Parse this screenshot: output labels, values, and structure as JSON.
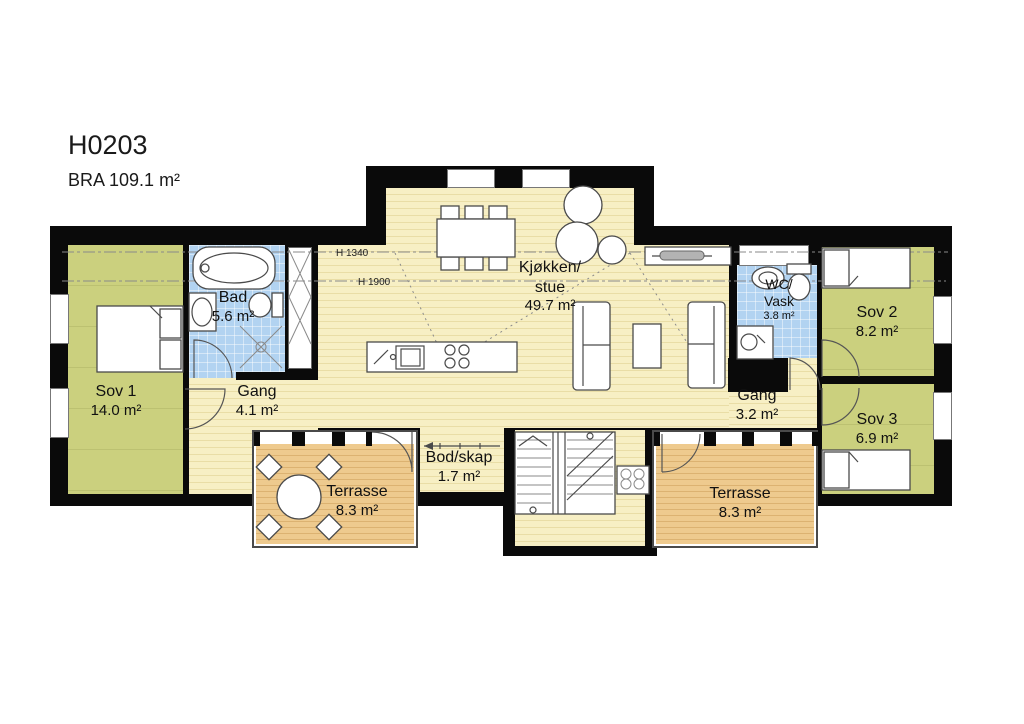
{
  "header": {
    "title": "H0203",
    "area_label": "BRA 109.1 m²"
  },
  "colors": {
    "wall_black": "#0a0a0a",
    "bedroom_green": "#cbd07e",
    "bathroom_blue": "#b2d3f1",
    "floor_yellow": "#f7efc4",
    "terrace_tan": "#eeca8e"
  },
  "rooms": {
    "sov1": {
      "name": "Sov 1",
      "area": "14.0 m²"
    },
    "bad": {
      "name": "Bad",
      "area": "5.6 m²"
    },
    "gang1": {
      "name": "Gang",
      "area": "4.1 m²"
    },
    "kjokken_stue": {
      "name_line1": "Kjøkken/",
      "name_line2": "stue",
      "area": "49.7 m²"
    },
    "wc_vask": {
      "name_line1": "WC/",
      "name_line2": "Vask",
      "area": "3.8 m²"
    },
    "sov2": {
      "name": "Sov 2",
      "area": "8.2 m²"
    },
    "sov3": {
      "name": "Sov 3",
      "area": "6.9 m²"
    },
    "gang2": {
      "name": "Gang",
      "area": "3.2 m²"
    },
    "bod_skap": {
      "name": "Bod/skap",
      "area": "1.7 m²"
    },
    "terrasse_left": {
      "name": "Terrasse",
      "area": "8.3 m²"
    },
    "terrasse_right": {
      "name": "Terrasse",
      "area": "8.3 m²"
    }
  },
  "annotations": {
    "ceiling_height_1": "H 1340",
    "ceiling_height_2": "H 1900"
  }
}
